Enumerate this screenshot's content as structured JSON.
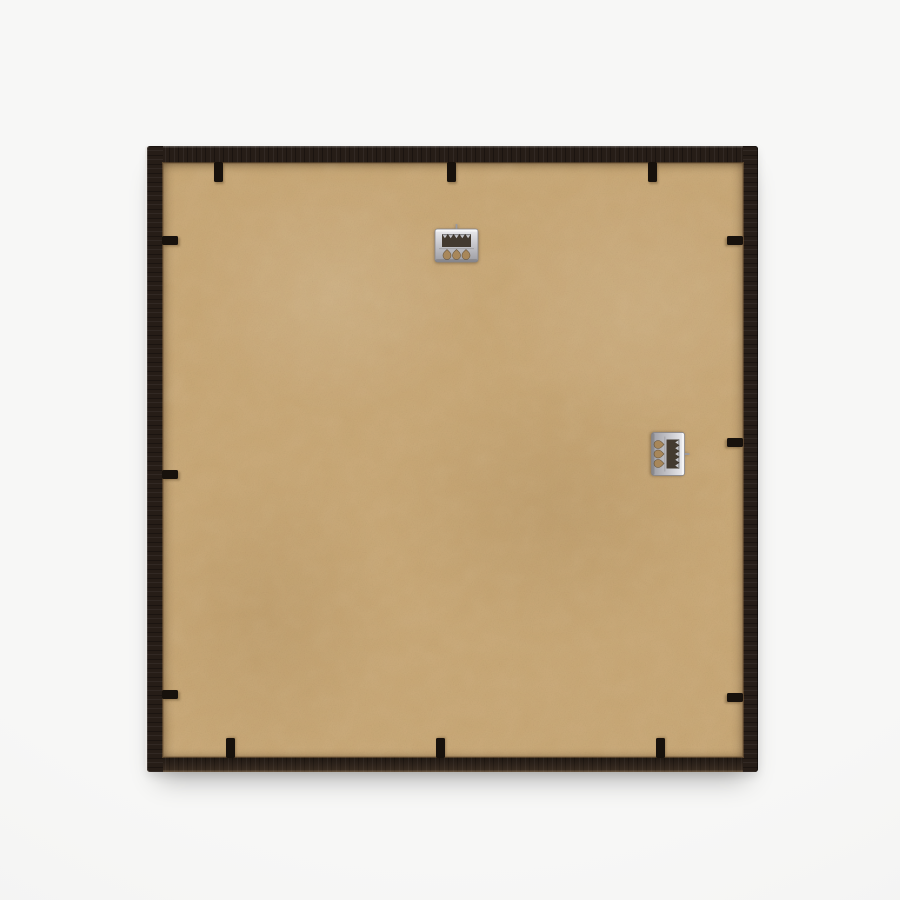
{
  "scene": {
    "subject": "back of a square dark-wood picture frame with kraft MDF backing board",
    "frame_rect": {
      "left": 147,
      "top": 146,
      "width": 611,
      "height": 626
    },
    "border": {
      "top": 17,
      "right": 15,
      "bottom": 15,
      "left": 16
    },
    "hangers": [
      {
        "name": "sawtooth-hanger-top",
        "type": "sawtooth-hanger",
        "cx": 456,
        "cy": 245,
        "rotation": 0
      },
      {
        "name": "sawtooth-hanger-right",
        "type": "sawtooth-hanger",
        "cx": 668,
        "cy": 454,
        "rotation": 90
      }
    ],
    "flex_tabs": [
      {
        "edge": "top",
        "x": 218,
        "y": 162
      },
      {
        "edge": "top",
        "x": 451,
        "y": 162
      },
      {
        "edge": "top",
        "x": 652,
        "y": 162
      },
      {
        "edge": "bottom",
        "x": 230,
        "y": 758
      },
      {
        "edge": "bottom",
        "x": 440,
        "y": 758
      },
      {
        "edge": "bottom",
        "x": 660,
        "y": 758
      },
      {
        "edge": "left",
        "x": 162,
        "y": 240
      },
      {
        "edge": "left",
        "x": 162,
        "y": 474
      },
      {
        "edge": "left",
        "x": 162,
        "y": 694
      },
      {
        "edge": "right",
        "x": 743,
        "y": 240
      },
      {
        "edge": "right",
        "x": 743,
        "y": 442
      },
      {
        "edge": "right",
        "x": 743,
        "y": 697
      }
    ]
  },
  "colors": {
    "page-bg": "#f5f5f4",
    "page-bg-light": "#f7f7f6",
    "page-bg-dark": "#efefee",
    "frame-dark": "#261d17",
    "backing": "#c9a876",
    "backing-shade": "#a8875a",
    "rabbet": "rgba(150,116,72,0.45)",
    "metal-light": "#ededf0",
    "metal-mid": "#c4c4c9",
    "metal-dark": "#9c9ca2",
    "metal-hole": "#433a30",
    "tab": "#17110c",
    "pin": "#9a9aa0"
  }
}
